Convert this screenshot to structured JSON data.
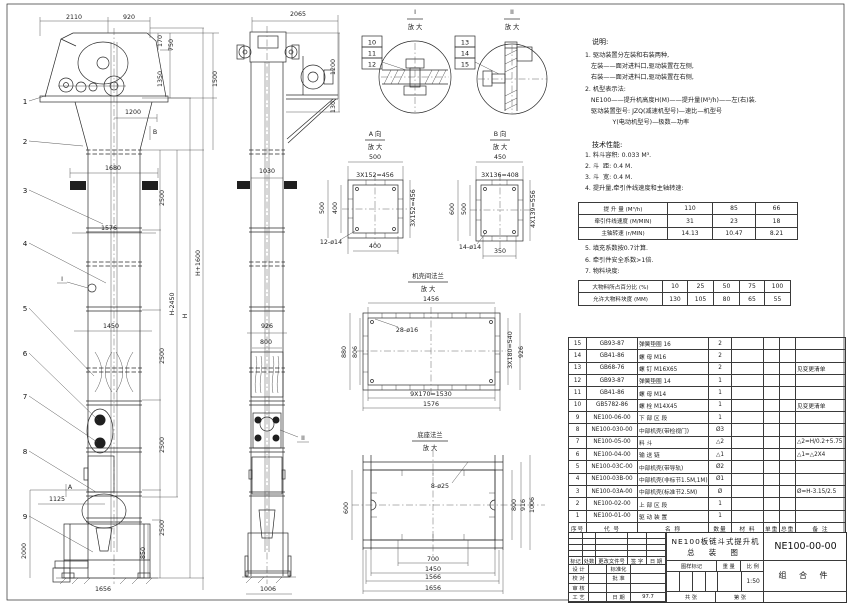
{
  "drawing": {
    "sheet_name": "NE100板链斗式提升机总装图"
  },
  "notes": {
    "title": "说明:",
    "lines": [
      "1. 驱动装置分左装和右装两种,",
      "   左装——面对进料口,驱动装置在左侧,",
      "   右装——面对进料口,驱动装置在右侧,",
      "2. 机型表示法:",
      "   NE100——提升机高度H(M)——提升量(M³/h)——左(右)装.",
      "   驱动装置型号: JZQ(减速机型号)—速比—机型号",
      "              Y(电动机型号)—极数—功率"
    ]
  },
  "specs": {
    "title": "技术性能:",
    "items_before": [
      "1. 料斗容积: 0.033 M³.",
      "2. 斗  距: 0.4 M.",
      "3. 斗  宽: 0.4 M.",
      "4. 提升量,牵引件线速度和主轴转速:"
    ],
    "items_after": [
      "5. 填充系数按0.7计算.",
      "6. 牵引件安全系数>1倍.",
      "7. 物料块度:"
    ]
  },
  "chart_data": [
    {
      "type": "table",
      "title": "提升量、牵引件线速度和主轴转速",
      "rows": [
        {
          "label": "提 升 量 (M³/h)",
          "values": [
            110,
            85,
            66
          ]
        },
        {
          "label": "牵引件线速度 (M/MIN)",
          "values": [
            31,
            23,
            18
          ]
        },
        {
          "label": "主轴转速 (r/MIN)",
          "values": [
            14.13,
            10.47,
            8.21
          ]
        }
      ]
    },
    {
      "type": "table",
      "title": "物料块度",
      "rows": [
        {
          "label": "大物料所占百分比 (%)",
          "values": [
            10,
            25,
            50,
            75,
            100
          ]
        },
        {
          "label": "允许大物料块度 (MM)",
          "values": [
            130,
            105,
            80,
            65,
            55
          ]
        }
      ]
    }
  ],
  "perf_table": {
    "rows": [
      {
        "label": "提 升 量  (M³/h)",
        "values": [
          "110",
          "85",
          "66"
        ]
      },
      {
        "label": "牵引件线速度 (M/MIN)",
        "values": [
          "31",
          "23",
          "18"
        ]
      },
      {
        "label": "主轴转速 (r/MIN)",
        "values": [
          "14.13",
          "10.47",
          "8.21"
        ]
      }
    ]
  },
  "size_table": {
    "rows": [
      {
        "label": "大物料所占百分比 (%)",
        "values": [
          "10",
          "25",
          "50",
          "75",
          "100"
        ]
      },
      {
        "label": "允许大物料块度 (MM)",
        "values": [
          "130",
          "105",
          "80",
          "65",
          "55"
        ]
      }
    ]
  },
  "bom": {
    "headers": [
      "序号",
      "代  号",
      "名  称",
      "数量",
      "材  料",
      "单重",
      "总重",
      "备 注"
    ],
    "rows": [
      [
        "15",
        "GB93-87",
        "弹簧垫圈 16",
        "2",
        "",
        "",
        "",
        ""
      ],
      [
        "14",
        "GB41-86",
        "螺 母  M16",
        "2",
        "",
        "",
        "",
        ""
      ],
      [
        "13",
        "GB68-76",
        "螺 钉  M16X65",
        "2",
        "",
        "",
        "",
        "见变更清单"
      ],
      [
        "12",
        "GB93-87",
        "弹簧垫圈 14",
        "1",
        "",
        "",
        "",
        ""
      ],
      [
        "11",
        "GB41-86",
        "螺 母  M14",
        "1",
        "",
        "",
        "",
        ""
      ],
      [
        "10",
        "GB5782-86",
        "螺 栓  M14X45",
        "1",
        "",
        "",
        "",
        "见变更清单"
      ],
      [
        "9",
        "NE100-06-00",
        "下 部 区 段",
        "1",
        "",
        "",
        "",
        ""
      ],
      [
        "8",
        "NE100-030-00",
        "中部机壳(带检视门)",
        "Ø3",
        "",
        "",
        "",
        ""
      ],
      [
        "7",
        "NE100-05-00",
        "料  斗",
        "△2",
        "",
        "",
        "",
        "△2=H/0.2+5.75"
      ],
      [
        "6",
        "NE100-04-00",
        "输 送 链",
        "△1",
        "",
        "",
        "",
        "△1=△2X4"
      ],
      [
        "5",
        "NE100-03C-00",
        "中部机壳(带导轨)",
        "Ø2",
        "",
        "",
        "",
        ""
      ],
      [
        "4",
        "NE100-03B-00",
        "中部机壳(非标节1.5M,1M)",
        "Ø1",
        "",
        "",
        "",
        ""
      ],
      [
        "3",
        "NE100-03A-00",
        "中部机壳(标准节2.5M)",
        "Ø",
        "",
        "",
        "",
        "Ø=H-3.15/2.5"
      ],
      [
        "2",
        "NE100-02-00",
        "上 部 区 段",
        "1",
        "",
        "",
        "",
        ""
      ],
      [
        "1",
        "NE100-01-00",
        "驱 动 装 置",
        "1",
        "",
        "",
        "",
        ""
      ]
    ]
  },
  "title_block": {
    "title_line1": "NE100板链斗式提升机",
    "title_line2": "总  装  图",
    "drawing_no": "NE100-00-00",
    "part_type": "组 合 件",
    "rev_headers": [
      "标记",
      "处数",
      "更改文件号",
      "签 字",
      "日 期"
    ],
    "sig_rows": [
      [
        "设 计",
        "",
        "标准化",
        ""
      ],
      [
        "校 对",
        "",
        "批 准",
        ""
      ],
      [
        "审 核",
        "",
        "",
        ""
      ],
      [
        "工 艺",
        "",
        "日 期",
        "97.7"
      ]
    ],
    "stamp_headers": [
      "图样标记",
      "重 量",
      "比 例"
    ],
    "scale": "1:50",
    "sheet_row": [
      "共   张",
      "第   张"
    ]
  },
  "labels": [
    {
      "t": "2110",
      "x": 74,
      "y": 19
    },
    {
      "t": "920",
      "x": 129,
      "y": 19
    },
    {
      "t": "170",
      "x": 162,
      "y": 41,
      "r": -90
    },
    {
      "t": "750",
      "x": 173,
      "y": 45,
      "r": -90
    },
    {
      "t": "1350",
      "x": 162,
      "y": 79,
      "r": -90
    },
    {
      "t": "1500",
      "x": 217,
      "y": 79,
      "r": -90
    },
    {
      "t": "1200",
      "x": 133,
      "y": 114
    },
    {
      "t": "B",
      "x": 155,
      "y": 134,
      "name": "section-b-label"
    },
    {
      "t": "1680",
      "x": 113,
      "y": 170
    },
    {
      "t": "2500",
      "x": 164,
      "y": 198,
      "r": -90
    },
    {
      "t": "1576",
      "x": 109,
      "y": 230
    },
    {
      "t": "H+1600",
      "x": 200,
      "y": 263,
      "r": -90
    },
    {
      "t": "I",
      "x": 62,
      "y": 281,
      "name": "detail-i-ref"
    },
    {
      "t": "H-2450",
      "x": 174,
      "y": 304,
      "r": -90
    },
    {
      "t": "H",
      "x": 187,
      "y": 316,
      "r": -90
    },
    {
      "t": "1450",
      "x": 111,
      "y": 328
    },
    {
      "t": "2500",
      "x": 164,
      "y": 356,
      "r": -90
    },
    {
      "t": "2500",
      "x": 164,
      "y": 445,
      "r": -90
    },
    {
      "t": "A",
      "x": 70,
      "y": 489,
      "name": "section-a-label"
    },
    {
      "t": "1125",
      "x": 57,
      "y": 501
    },
    {
      "t": "2500",
      "x": 164,
      "y": 528,
      "r": -90
    },
    {
      "t": "2000",
      "x": 26,
      "y": 551,
      "r": -90
    },
    {
      "t": "850",
      "x": 145,
      "y": 553,
      "r": -90
    },
    {
      "t": "1656",
      "x": 103,
      "y": 591
    },
    {
      "t": "2065",
      "x": 298,
      "y": 16
    },
    {
      "t": "1200",
      "x": 335,
      "y": 67,
      "r": -90
    },
    {
      "t": "130",
      "x": 335,
      "y": 107,
      "r": -90
    },
    {
      "t": "1030",
      "x": 267,
      "y": 173
    },
    {
      "t": "926",
      "x": 267,
      "y": 328
    },
    {
      "t": "800",
      "x": 266,
      "y": 344
    },
    {
      "t": "II",
      "x": 303,
      "y": 440,
      "name": "detail-ii-ref"
    },
    {
      "t": "1006",
      "x": 268,
      "y": 591
    },
    {
      "t": "I",
      "x": 415,
      "y": 14,
      "name": "detail-i-title"
    },
    {
      "t": "放 大",
      "x": 415,
      "y": 29
    },
    {
      "t": "II",
      "x": 512,
      "y": 14,
      "name": "detail-ii-title"
    },
    {
      "t": "放 大",
      "x": 512,
      "y": 29
    },
    {
      "t": "A 向",
      "x": 375,
      "y": 136,
      "name": "view-a-title"
    },
    {
      "t": "放 大",
      "x": 375,
      "y": 149
    },
    {
      "t": "500",
      "x": 375,
      "y": 159
    },
    {
      "t": "3X152=456",
      "x": 375,
      "y": 177
    },
    {
      "t": "500",
      "x": 324,
      "y": 208,
      "r": -90
    },
    {
      "t": "400",
      "x": 337,
      "y": 208,
      "r": -90
    },
    {
      "t": "3X152=456",
      "x": 415,
      "y": 208,
      "r": -90
    },
    {
      "t": "12-ø14",
      "x": 331,
      "y": 244
    },
    {
      "t": "400",
      "x": 375,
      "y": 248
    },
    {
      "t": "B 向",
      "x": 500,
      "y": 136,
      "name": "view-b-title"
    },
    {
      "t": "放 大",
      "x": 500,
      "y": 149
    },
    {
      "t": "450",
      "x": 500,
      "y": 159
    },
    {
      "t": "3X136=408",
      "x": 500,
      "y": 177
    },
    {
      "t": "600",
      "x": 454,
      "y": 209,
      "r": -90
    },
    {
      "t": "500",
      "x": 466,
      "y": 209,
      "r": -90
    },
    {
      "t": "4X139=556",
      "x": 535,
      "y": 209,
      "r": -90
    },
    {
      "t": "14-ø14",
      "x": 470,
      "y": 249
    },
    {
      "t": "350",
      "x": 500,
      "y": 253
    },
    {
      "t": "机壳间法兰",
      "x": 428,
      "y": 278,
      "name": "flange-detail-title"
    },
    {
      "t": "放 大",
      "x": 428,
      "y": 291
    },
    {
      "t": "1456",
      "x": 431,
      "y": 301
    },
    {
      "t": "28-ø16",
      "x": 407,
      "y": 332
    },
    {
      "t": "880",
      "x": 346,
      "y": 352,
      "r": -90
    },
    {
      "t": "806",
      "x": 357,
      "y": 352,
      "r": -90
    },
    {
      "t": "3X180=540",
      "x": 512,
      "y": 350,
      "r": -90
    },
    {
      "t": "926",
      "x": 523,
      "y": 352,
      "r": -90
    },
    {
      "t": "9X170=1530",
      "x": 431,
      "y": 396
    },
    {
      "t": "1576",
      "x": 431,
      "y": 406
    },
    {
      "t": "底座法兰",
      "x": 430,
      "y": 437,
      "name": "base-flange-title"
    },
    {
      "t": "放 大",
      "x": 430,
      "y": 450
    },
    {
      "t": "8-ø25",
      "x": 440,
      "y": 488
    },
    {
      "t": "600",
      "x": 348,
      "y": 508,
      "r": -90
    },
    {
      "t": "800",
      "x": 516,
      "y": 505,
      "r": -90
    },
    {
      "t": "916",
      "x": 525,
      "y": 505,
      "r": -90
    },
    {
      "t": "1006",
      "x": 534,
      "y": 505,
      "r": -90
    },
    {
      "t": "700",
      "x": 433,
      "y": 561
    },
    {
      "t": "1450",
      "x": 433,
      "y": 571
    },
    {
      "t": "1566",
      "x": 433,
      "y": 579
    },
    {
      "t": "1656",
      "x": 433,
      "y": 590
    }
  ],
  "balloons": [
    {
      "n": "1",
      "x": 25,
      "y": 104
    },
    {
      "n": "2",
      "x": 25,
      "y": 144
    },
    {
      "n": "3",
      "x": 25,
      "y": 193
    },
    {
      "n": "4",
      "x": 25,
      "y": 246
    },
    {
      "n": "5",
      "x": 25,
      "y": 311
    },
    {
      "n": "6",
      "x": 25,
      "y": 356
    },
    {
      "n": "7",
      "x": 25,
      "y": 399
    },
    {
      "n": "8",
      "x": 25,
      "y": 454
    },
    {
      "n": "9",
      "x": 25,
      "y": 519
    }
  ],
  "ref_boxes": [
    {
      "n": "10",
      "x": 362,
      "y": 36
    },
    {
      "n": "11",
      "x": 362,
      "y": 47
    },
    {
      "n": "12",
      "x": 362,
      "y": 58
    },
    {
      "n": "13",
      "x": 455,
      "y": 36
    },
    {
      "n": "14",
      "x": 455,
      "y": 47
    },
    {
      "n": "15",
      "x": 455,
      "y": 58
    }
  ]
}
